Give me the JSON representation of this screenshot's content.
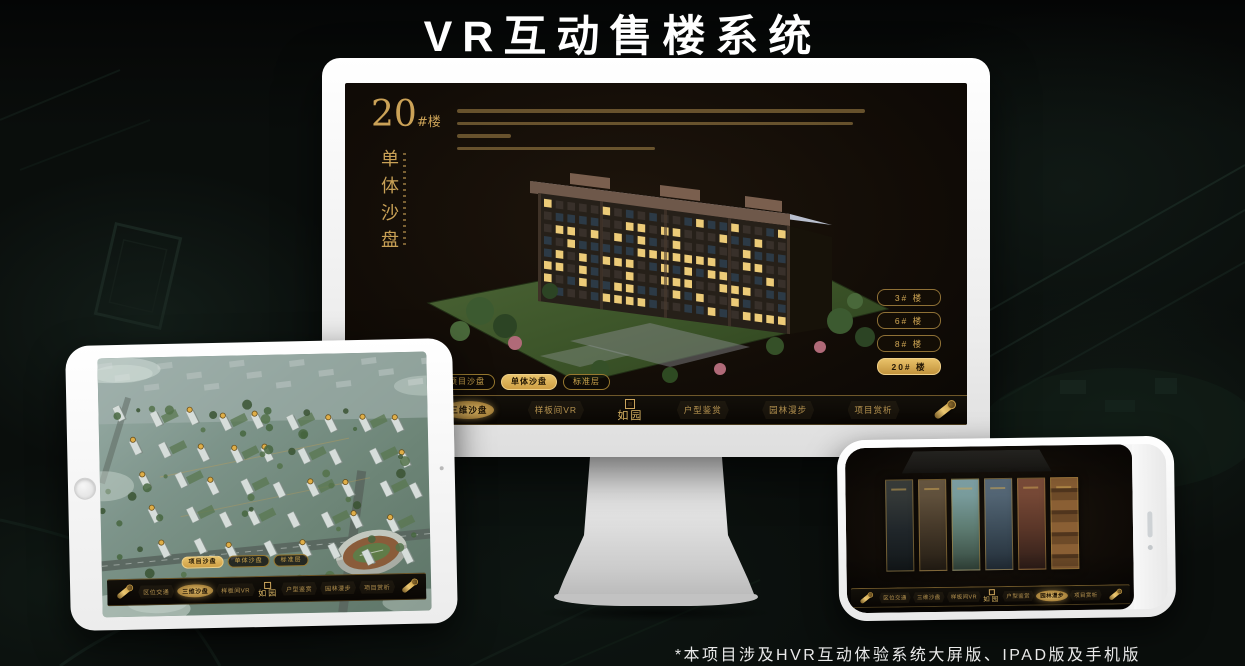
{
  "page": {
    "title": "VR互动售楼系统",
    "footnote": "*本项目涉及HVR互动体验系统大屏版、IPAD版及手机版"
  },
  "colors": {
    "accent_gold": "#d2a855",
    "accent_gold_bright": "#e6c26a",
    "screen_bg": "#140f09",
    "page_bg": "#0a0e0c",
    "device_white": "#f4f4f4"
  },
  "monitor": {
    "headline": {
      "number": "20",
      "suffix": "#楼",
      "vertical_title": "单体沙盘"
    },
    "floor_buttons": [
      {
        "label": "3# 楼",
        "active": false
      },
      {
        "label": "6# 楼",
        "active": false
      },
      {
        "label": "8# 楼",
        "active": false
      },
      {
        "label": "20# 楼",
        "active": true
      }
    ],
    "sub_tabs": [
      {
        "label": "项目沙盘",
        "active": false
      },
      {
        "label": "单体沙盘",
        "active": true
      },
      {
        "label": "标准层",
        "active": false
      }
    ],
    "nav": {
      "logo": "如园",
      "items": [
        {
          "label": "区位交通",
          "active": false
        },
        {
          "label": "三维沙盘",
          "active": true
        },
        {
          "label": "样板间VR",
          "active": false
        },
        {
          "label": "户型鉴赏",
          "active": false
        },
        {
          "label": "园林漫步",
          "active": false
        },
        {
          "label": "项目赏析",
          "active": false
        }
      ]
    }
  },
  "ipad": {
    "sub_tabs": [
      {
        "label": "项目沙盘",
        "active": true
      },
      {
        "label": "单体沙盘",
        "active": false
      },
      {
        "label": "标准层",
        "active": false
      }
    ],
    "nav": {
      "logo": "如园",
      "items": [
        {
          "label": "区位交通",
          "active": false
        },
        {
          "label": "三维沙盘",
          "active": true
        },
        {
          "label": "样板间VR",
          "active": false
        },
        {
          "label": "户型鉴赏",
          "active": false
        },
        {
          "label": "园林漫步",
          "active": false
        },
        {
          "label": "项目赏析",
          "active": false
        }
      ]
    }
  },
  "phone": {
    "nav": {
      "logo": "如园",
      "items": [
        {
          "label": "区位交通",
          "active": false
        },
        {
          "label": "三维沙盘",
          "active": false
        },
        {
          "label": "样板间VR",
          "active": false
        },
        {
          "label": "户型鉴赏",
          "active": false
        },
        {
          "label": "园林漫步",
          "active": true
        },
        {
          "label": "项目赏析",
          "active": false
        }
      ]
    }
  }
}
